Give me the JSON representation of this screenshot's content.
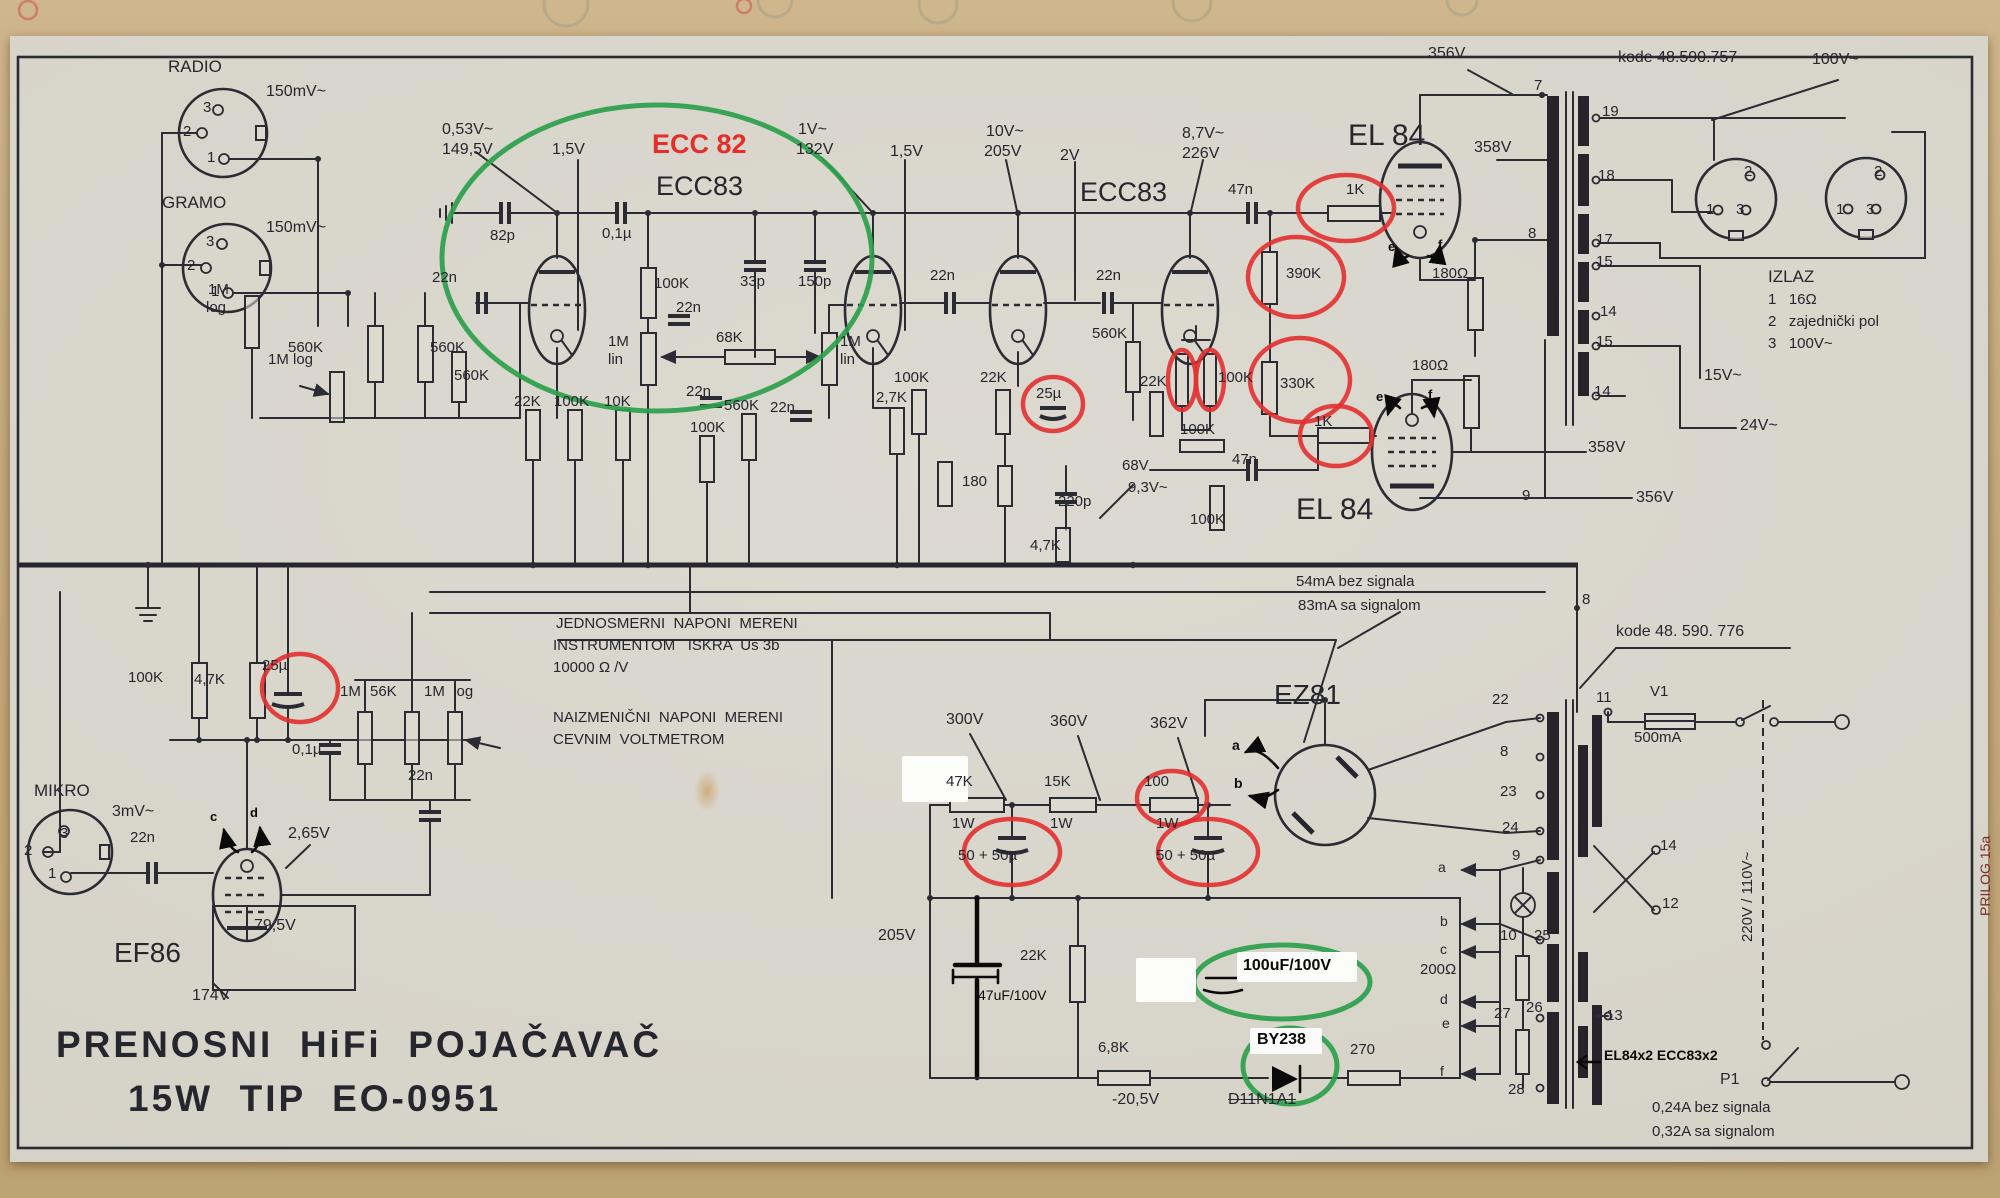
{
  "title": {
    "line1": "PRENOSNI  HiFi  POJAČAVAČ",
    "line2": "15W  TIP  EO-0951"
  },
  "highlights": {
    "red_circled_values": [
      "1K",
      "390K",
      "330K",
      "1K",
      "25µ",
      "25µ",
      "100K",
      "100K",
      "100 1W",
      "50+50µ",
      "50+50µ"
    ],
    "green_circled_notes": [
      "ECC 82 (first stage tube substitution)",
      "100uF/100V",
      "BY238"
    ],
    "struck_out": "D11N1A1",
    "colors": {
      "red_annotation": "#e62e28",
      "green_annotation": "#2ca04c",
      "print_ink": "#26262e"
    }
  },
  "labels": [
    {
      "n": "radio-label",
      "t": "RADIO",
      "x": 168,
      "y": 58,
      "fs": 17
    },
    {
      "n": "radio-level",
      "t": "150mV~",
      "x": 266,
      "y": 84,
      "fs": 16
    },
    {
      "n": "radio-pin-3",
      "t": "3",
      "x": 203,
      "y": 100
    },
    {
      "n": "radio-pin-2",
      "t": "2",
      "x": 183,
      "y": 124
    },
    {
      "n": "radio-pin-1",
      "t": "1",
      "x": 207,
      "y": 150
    },
    {
      "n": "gramo-label",
      "t": "GRAMO",
      "x": 162,
      "y": 194,
      "fs": 17
    },
    {
      "n": "gramo-level",
      "t": "150mV~",
      "x": 266,
      "y": 220,
      "fs": 16
    },
    {
      "n": "gramo-pin-3",
      "t": "3",
      "x": 206,
      "y": 234
    },
    {
      "n": "gramo-pin-2",
      "t": "2",
      "x": 187,
      "y": 258
    },
    {
      "n": "gramo-pin-1",
      "t": "1",
      "x": 211,
      "y": 284
    },
    {
      "n": "mikro-label",
      "t": "MIKRO",
      "x": 34,
      "y": 782,
      "fs": 17
    },
    {
      "n": "mikro-level",
      "t": "3mV~",
      "x": 112,
      "y": 804,
      "fs": 16
    },
    {
      "n": "mikro-pin-2",
      "t": "2",
      "x": 24,
      "y": 843
    },
    {
      "n": "mikro-pin-3",
      "t": "3",
      "x": 60,
      "y": 826
    },
    {
      "n": "mikro-pin-1",
      "t": "1",
      "x": 48,
      "y": 866
    },
    {
      "n": "v-053",
      "t": "0,53V~",
      "x": 442,
      "y": 122,
      "fs": 16
    },
    {
      "n": "v-1495",
      "t": "149,5V",
      "x": 442,
      "y": 142,
      "fs": 16
    },
    {
      "n": "v-15a",
      "t": "1,5V",
      "x": 552,
      "y": 142,
      "fs": 16
    },
    {
      "t": "82p",
      "x": 490,
      "y": 228
    },
    {
      "t": "22n",
      "x": 432,
      "y": 270
    },
    {
      "t": "560K",
      "x": 288,
      "y": 340
    },
    {
      "t": "560K",
      "x": 430,
      "y": 340
    },
    {
      "t": "560K",
      "x": 454,
      "y": 368
    },
    {
      "t": "1M",
      "x": 208,
      "y": 282
    },
    {
      "t": "log",
      "x": 206,
      "y": 300
    },
    {
      "t": "1M log",
      "x": 268,
      "y": 352
    },
    {
      "n": "ecc82-annotation",
      "t": "ECC 82",
      "x": 652,
      "y": 130,
      "fs": 27,
      "b": 1,
      "c": "red"
    },
    {
      "n": "tube-label-ecc83-1",
      "t": "ECC83",
      "x": 656,
      "y": 172,
      "fs": 27
    },
    {
      "n": "v-1v",
      "t": "1V~",
      "x": 798,
      "y": 122,
      "fs": 16
    },
    {
      "n": "v-132",
      "t": "132V",
      "x": 796,
      "y": 142,
      "fs": 16
    },
    {
      "n": "v-15b",
      "t": "1,5V",
      "x": 890,
      "y": 144,
      "fs": 16
    },
    {
      "t": "0,1µ",
      "x": 602,
      "y": 226
    },
    {
      "t": "100K",
      "x": 654,
      "y": 276
    },
    {
      "t": "22n",
      "x": 676,
      "y": 300
    },
    {
      "t": "33p",
      "x": 740,
      "y": 274
    },
    {
      "t": "150p",
      "x": 798,
      "y": 274
    },
    {
      "t": "1M",
      "x": 608,
      "y": 334
    },
    {
      "t": "lin",
      "x": 608,
      "y": 352
    },
    {
      "t": "68K",
      "x": 716,
      "y": 330
    },
    {
      "t": "1M",
      "x": 840,
      "y": 334
    },
    {
      "t": "lin",
      "x": 840,
      "y": 352
    },
    {
      "t": "22n",
      "x": 686,
      "y": 384
    },
    {
      "t": "22n",
      "x": 770,
      "y": 400
    },
    {
      "t": "22K",
      "x": 514,
      "y": 394
    },
    {
      "t": "100K",
      "x": 554,
      "y": 394
    },
    {
      "t": "10K",
      "x": 604,
      "y": 394
    },
    {
      "t": "100K",
      "x": 690,
      "y": 420
    },
    {
      "t": "560K",
      "x": 724,
      "y": 398
    },
    {
      "t": "2,7K",
      "x": 876,
      "y": 390
    },
    {
      "n": "tube-label-ecc83-2",
      "t": "ECC83",
      "x": 1080,
      "y": 178,
      "fs": 27
    },
    {
      "n": "v-10v",
      "t": "10V~",
      "x": 986,
      "y": 124,
      "fs": 16
    },
    {
      "n": "v-205a",
      "t": "205V",
      "x": 984,
      "y": 144,
      "fs": 16
    },
    {
      "n": "v-2v",
      "t": "2V",
      "x": 1060,
      "y": 148,
      "fs": 16
    },
    {
      "n": "v-87",
      "t": "8,7V~",
      "x": 1182,
      "y": 126,
      "fs": 16
    },
    {
      "n": "v-226",
      "t": "226V",
      "x": 1182,
      "y": 146,
      "fs": 16
    },
    {
      "t": "22n",
      "x": 930,
      "y": 268
    },
    {
      "t": "22n",
      "x": 1096,
      "y": 268
    },
    {
      "t": "560K",
      "x": 1092,
      "y": 326
    },
    {
      "t": "100K",
      "x": 894,
      "y": 370
    },
    {
      "t": "22K",
      "x": 980,
      "y": 370
    },
    {
      "t": "25µ",
      "x": 1036,
      "y": 386
    },
    {
      "t": "22K",
      "x": 1140,
      "y": 374
    },
    {
      "t": "100K",
      "x": 1218,
      "y": 370
    },
    {
      "t": "100K",
      "x": 1180,
      "y": 422
    },
    {
      "t": "180",
      "x": 962,
      "y": 474
    },
    {
      "t": "220p",
      "x": 1058,
      "y": 494
    },
    {
      "n": "v-68",
      "t": "68V",
      "x": 1122,
      "y": 458,
      "fs": 15
    },
    {
      "n": "v-93",
      "t": "9,3V~",
      "x": 1128,
      "y": 480,
      "fs": 15
    },
    {
      "t": "100K",
      "x": 1190,
      "y": 512
    },
    {
      "t": "4,7K",
      "x": 1030,
      "y": 538
    },
    {
      "t": "47n",
      "x": 1228,
      "y": 182
    },
    {
      "t": "47n",
      "x": 1232,
      "y": 452
    },
    {
      "n": "tube-label-el84-1",
      "t": "EL 84",
      "x": 1348,
      "y": 120,
      "fs": 30
    },
    {
      "t": "1K",
      "x": 1346,
      "y": 182
    },
    {
      "t": "390K",
      "x": 1286,
      "y": 266
    },
    {
      "t": "330K",
      "x": 1280,
      "y": 376
    },
    {
      "t": "1K",
      "x": 1314,
      "y": 414
    },
    {
      "n": "tube-label-el84-2",
      "t": "EL 84",
      "x": 1296,
      "y": 494,
      "fs": 30
    },
    {
      "t": "180Ω",
      "x": 1432,
      "y": 266
    },
    {
      "t": "180Ω",
      "x": 1412,
      "y": 358
    },
    {
      "n": "v-356a",
      "t": "356V",
      "x": 1428,
      "y": 46,
      "fs": 16
    },
    {
      "n": "v-358a",
      "t": "358V",
      "x": 1474,
      "y": 140,
      "fs": 16
    },
    {
      "n": "v-358b",
      "t": "358V",
      "x": 1588,
      "y": 440,
      "fs": 16
    },
    {
      "n": "v-356b",
      "t": "356V",
      "x": 1636,
      "y": 490,
      "fs": 16
    },
    {
      "t": "9",
      "x": 1522,
      "y": 488
    },
    {
      "t": "7",
      "x": 1534,
      "y": 78
    },
    {
      "t": "8",
      "x": 1528,
      "y": 226
    },
    {
      "n": "hand-e-1",
      "t": "e",
      "x": 1388,
      "y": 240,
      "fs": 13,
      "b": 1,
      "c": "hand"
    },
    {
      "n": "hand-f-1",
      "t": "f",
      "x": 1438,
      "y": 238,
      "fs": 13,
      "b": 1,
      "c": "hand"
    },
    {
      "n": "hand-e-2",
      "t": "e",
      "x": 1376,
      "y": 390,
      "fs": 13,
      "b": 1,
      "c": "hand"
    },
    {
      "n": "hand-f-2",
      "t": "f",
      "x": 1428,
      "y": 388,
      "fs": 13,
      "b": 1,
      "c": "hand"
    },
    {
      "n": "kode-757",
      "t": "kode 48.590.757",
      "x": 1618,
      "y": 50,
      "fs": 16
    },
    {
      "n": "v-100v-top",
      "t": "100V~",
      "x": 1812,
      "y": 52,
      "fs": 16
    },
    {
      "t": "19",
      "x": 1602,
      "y": 104
    },
    {
      "t": "18",
      "x": 1598,
      "y": 168
    },
    {
      "t": "17",
      "x": 1596,
      "y": 232
    },
    {
      "t": "15",
      "x": 1596,
      "y": 254
    },
    {
      "t": "14",
      "x": 1600,
      "y": 304
    },
    {
      "t": "15",
      "x": 1596,
      "y": 334
    },
    {
      "t": "14",
      "x": 1594,
      "y": 384
    },
    {
      "n": "out1-pin-2",
      "t": "2",
      "x": 1744,
      "y": 164
    },
    {
      "n": "out1-pin-1",
      "t": "1",
      "x": 1706,
      "y": 202
    },
    {
      "n": "out1-pin-3",
      "t": "3",
      "x": 1736,
      "y": 202
    },
    {
      "n": "out2-pin-2",
      "t": "2",
      "x": 1874,
      "y": 164
    },
    {
      "n": "out2-pin-1",
      "t": "1",
      "x": 1836,
      "y": 202
    },
    {
      "n": "out2-pin-3",
      "t": "3",
      "x": 1866,
      "y": 202
    },
    {
      "n": "izlaz-title",
      "t": "IZLAZ",
      "x": 1768,
      "y": 268,
      "fs": 17
    },
    {
      "n": "izlaz-1",
      "t": "1   16Ω",
      "x": 1768,
      "y": 292,
      "fs": 15
    },
    {
      "n": "izlaz-2",
      "t": "2   zajednički pol",
      "x": 1768,
      "y": 314,
      "fs": 15
    },
    {
      "n": "izlaz-3",
      "t": "3   100V~",
      "x": 1768,
      "y": 336,
      "fs": 15
    },
    {
      "n": "v-15v",
      "t": "15V~",
      "x": 1704,
      "y": 368,
      "fs": 16
    },
    {
      "n": "v-24v",
      "t": "24V~",
      "x": 1740,
      "y": 418,
      "fs": 16
    },
    {
      "n": "note-dc-1",
      "t": "JEDNOSMERNI  NAPONI  MERENI",
      "x": 556,
      "y": 616
    },
    {
      "n": "note-dc-2",
      "t": "INSTRUMENTOM   ISKRA  Us 3b",
      "x": 553,
      "y": 638
    },
    {
      "n": "note-dc-3",
      "t": "10000 Ω /V",
      "x": 553,
      "y": 660
    },
    {
      "n": "note-ac-1",
      "t": "NAIZMENIČNI  NAPONI  MERENI",
      "x": 553,
      "y": 710
    },
    {
      "n": "note-ac-2",
      "t": "CEVNIM  VOLTMETROM",
      "x": 553,
      "y": 732
    },
    {
      "n": "current-note-1",
      "t": "54mA bez signala",
      "x": 1296,
      "y": 574
    },
    {
      "n": "current-note-2",
      "t": "83mA sa signalom",
      "x": 1298,
      "y": 598
    },
    {
      "n": "tube-label-ez81",
      "t": "EZ81",
      "x": 1274,
      "y": 680,
      "fs": 28
    },
    {
      "n": "v-300",
      "t": "300V",
      "x": 946,
      "y": 712,
      "fs": 16
    },
    {
      "n": "v-360",
      "t": "360V",
      "x": 1050,
      "y": 714,
      "fs": 16
    },
    {
      "n": "v-362",
      "t": "362V",
      "x": 1150,
      "y": 716,
      "fs": 16
    },
    {
      "t": "47K",
      "x": 946,
      "y": 774
    },
    {
      "t": "1W",
      "x": 952,
      "y": 816
    },
    {
      "t": "15K",
      "x": 1044,
      "y": 774
    },
    {
      "t": "1W",
      "x": 1050,
      "y": 816
    },
    {
      "t": "100",
      "x": 1144,
      "y": 774
    },
    {
      "t": "1W",
      "x": 1156,
      "y": 816
    },
    {
      "t": "50 + 50µ",
      "x": 958,
      "y": 848
    },
    {
      "t": "50 + 50µ",
      "x": 1156,
      "y": 848
    },
    {
      "n": "v-205b",
      "t": "205V",
      "x": 878,
      "y": 928,
      "fs": 16
    },
    {
      "n": "annot-47uf",
      "t": "47uF/100V",
      "x": 978,
      "y": 988,
      "fs": 14,
      "c": "hand"
    },
    {
      "t": "22K",
      "x": 1020,
      "y": 948
    },
    {
      "t": "6,8K",
      "x": 1098,
      "y": 1040
    },
    {
      "n": "v-neg205",
      "t": "-20,5V",
      "x": 1112,
      "y": 1092,
      "fs": 16
    },
    {
      "n": "old-diode-label",
      "t": "D11N1A1",
      "x": 1228,
      "y": 1092,
      "fs": 16,
      "strike": 1
    },
    {
      "n": "annot-100uf",
      "t": "100uF/100V",
      "x": 1243,
      "y": 958,
      "fs": 16,
      "b": 1,
      "c": "hand"
    },
    {
      "n": "annot-by238",
      "t": "BY238",
      "x": 1257,
      "y": 1032,
      "fs": 16,
      "b": 1,
      "c": "hand"
    },
    {
      "t": "270",
      "x": 1350,
      "y": 1042
    },
    {
      "n": "annot-el84x2",
      "t": "EL84x2 ECC83x2",
      "x": 1604,
      "y": 1048,
      "fs": 14,
      "b": 1,
      "c": "hand"
    },
    {
      "n": "current-note-3",
      "t": "0,24A bez signala",
      "x": 1652,
      "y": 1100,
      "fs": 15
    },
    {
      "n": "current-note-4",
      "t": "0,32A sa signalom",
      "x": 1652,
      "y": 1124,
      "fs": 15
    },
    {
      "n": "kode-776",
      "t": "kode 48. 590. 776",
      "x": 1616,
      "y": 624,
      "fs": 16
    },
    {
      "t": "22",
      "x": 1492,
      "y": 692
    },
    {
      "t": "8",
      "x": 1500,
      "y": 744
    },
    {
      "t": "23",
      "x": 1500,
      "y": 784
    },
    {
      "t": "24",
      "x": 1502,
      "y": 820
    },
    {
      "t": "9",
      "x": 1512,
      "y": 848
    },
    {
      "t": "10",
      "x": 1500,
      "y": 928
    },
    {
      "t": "25",
      "x": 1534,
      "y": 928
    },
    {
      "t": "200Ω",
      "x": 1420,
      "y": 962
    },
    {
      "t": "27",
      "x": 1494,
      "y": 1006
    },
    {
      "t": "26",
      "x": 1526,
      "y": 1000
    },
    {
      "t": "28",
      "x": 1508,
      "y": 1082
    },
    {
      "t": "13",
      "x": 1606,
      "y": 1008
    },
    {
      "t": "11",
      "x": 1596,
      "y": 690
    },
    {
      "t": "V1",
      "x": 1650,
      "y": 684
    },
    {
      "t": "500mA",
      "x": 1634,
      "y": 730
    },
    {
      "t": "14",
      "x": 1660,
      "y": 838
    },
    {
      "t": "12",
      "x": 1662,
      "y": 896
    },
    {
      "n": "mains-voltage",
      "t": "220V / 110V~",
      "x": 1740,
      "y": 942,
      "fs": 15,
      "r": -90
    },
    {
      "n": "switch-p1",
      "t": "P1",
      "x": 1720,
      "y": 1072,
      "fs": 16
    },
    {
      "t": "a",
      "x": 1438,
      "y": 860,
      "fs": 14
    },
    {
      "t": "b",
      "x": 1440,
      "y": 914,
      "fs": 14
    },
    {
      "t": "c",
      "x": 1440,
      "y": 942,
      "fs": 14
    },
    {
      "t": "d",
      "x": 1440,
      "y": 992,
      "fs": 14
    },
    {
      "t": "e",
      "x": 1442,
      "y": 1016,
      "fs": 14
    },
    {
      "t": "f",
      "x": 1440,
      "y": 1064,
      "fs": 14
    },
    {
      "t": "8",
      "x": 1582,
      "y": 592
    },
    {
      "n": "hand-a",
      "t": "a",
      "x": 1232,
      "y": 738,
      "fs": 14,
      "b": 1,
      "c": "hand"
    },
    {
      "n": "hand-b",
      "t": "b",
      "x": 1234,
      "y": 776,
      "fs": 14,
      "b": 1,
      "c": "hand"
    },
    {
      "n": "hand-c",
      "t": "c",
      "x": 210,
      "y": 810,
      "fs": 13,
      "b": 1,
      "c": "hand"
    },
    {
      "n": "hand-d",
      "t": "d",
      "x": 250,
      "y": 806,
      "fs": 13,
      "b": 1,
      "c": "hand"
    },
    {
      "t": "100K",
      "x": 128,
      "y": 670
    },
    {
      "t": "4,7K",
      "x": 194,
      "y": 672
    },
    {
      "t": "25µ",
      "x": 262,
      "y": 658
    },
    {
      "t": "0,1µ",
      "x": 292,
      "y": 742
    },
    {
      "t": "1M",
      "x": 340,
      "y": 684
    },
    {
      "t": "56K",
      "x": 370,
      "y": 684
    },
    {
      "t": "1M  log",
      "x": 424,
      "y": 684
    },
    {
      "t": "22n",
      "x": 408,
      "y": 768
    },
    {
      "t": "22n",
      "x": 130,
      "y": 830
    },
    {
      "n": "v-265",
      "t": "2,65V",
      "x": 288,
      "y": 826,
      "fs": 16
    },
    {
      "n": "v-795",
      "t": "79,5V",
      "x": 254,
      "y": 918,
      "fs": 16
    },
    {
      "n": "tube-label-ef86",
      "t": "EF86",
      "x": 114,
      "y": 938,
      "fs": 28
    },
    {
      "n": "v-174",
      "t": "174V",
      "x": 192,
      "y": 988,
      "fs": 16
    },
    {
      "n": "title-line1",
      "t": "PRENOSNI  HiFi  POJAČAVAČ",
      "x": 56,
      "y": 1026,
      "fs": 37,
      "b": 1,
      "ls": 3
    },
    {
      "n": "title-line2",
      "t": "15W  TIP  EO-0951",
      "x": 128,
      "y": 1080,
      "fs": 37,
      "b": 1,
      "ls": 3
    },
    {
      "n": "prilog-note",
      "t": "PRILOG 15a",
      "x": 1978,
      "y": 916,
      "fs": 14,
      "r": -90,
      "c": "edge"
    }
  ]
}
